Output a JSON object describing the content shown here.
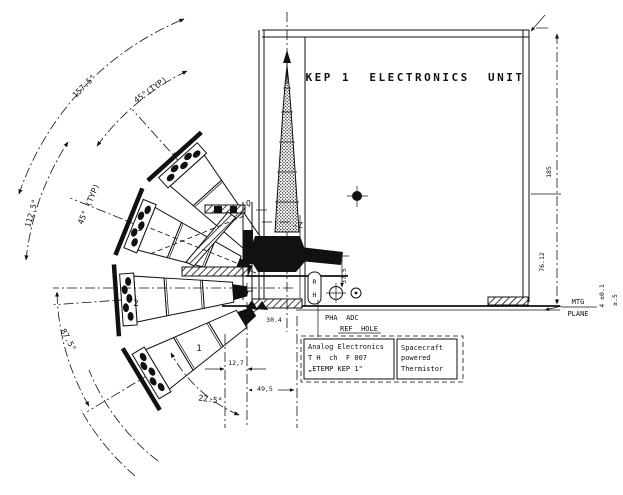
{
  "drawing": {
    "title": "KEP 1  ELECTRONICS  UNIT",
    "axis": {
      "q": "Q",
      "z": "-Z",
      "x": "X"
    },
    "detectors": {
      "d1": "1",
      "d2": "2",
      "d3": "3",
      "d4": "4"
    },
    "angles": {
      "a1575": "157.5°",
      "a45t_top": "45°(TYP)",
      "a1125": "112.5°",
      "a45t_mid": "45° (TYP)",
      "a875": "87.5°",
      "a225": "22.5°"
    },
    "dims": {
      "w127": "12,7",
      "w495": "49,5",
      "w304": "30.4",
      "h375": "37.5",
      "h185": "185",
      "h7612": "76.12",
      "mtg_t1": "MTG",
      "mtg_t2": "PLANE",
      "tol4": "4 ±0.1",
      "tol5": "±.5"
    },
    "labels": {
      "pha": "PHA  ADC",
      "ref": "REF  HOLE",
      "rh_r": "R",
      "rh_h": "H"
    },
    "notes": {
      "analog": {
        "l1": "Analog Electronics",
        "l2": "T H  ch  F 007",
        "l3": "„ETEMP KEP 1\""
      },
      "thermistor": {
        "l1": "Spacecraft",
        "l2": "powered",
        "l3": "Thermistor"
      }
    },
    "colors": {
      "ink": "#111111",
      "paper": "#ffffff"
    }
  }
}
